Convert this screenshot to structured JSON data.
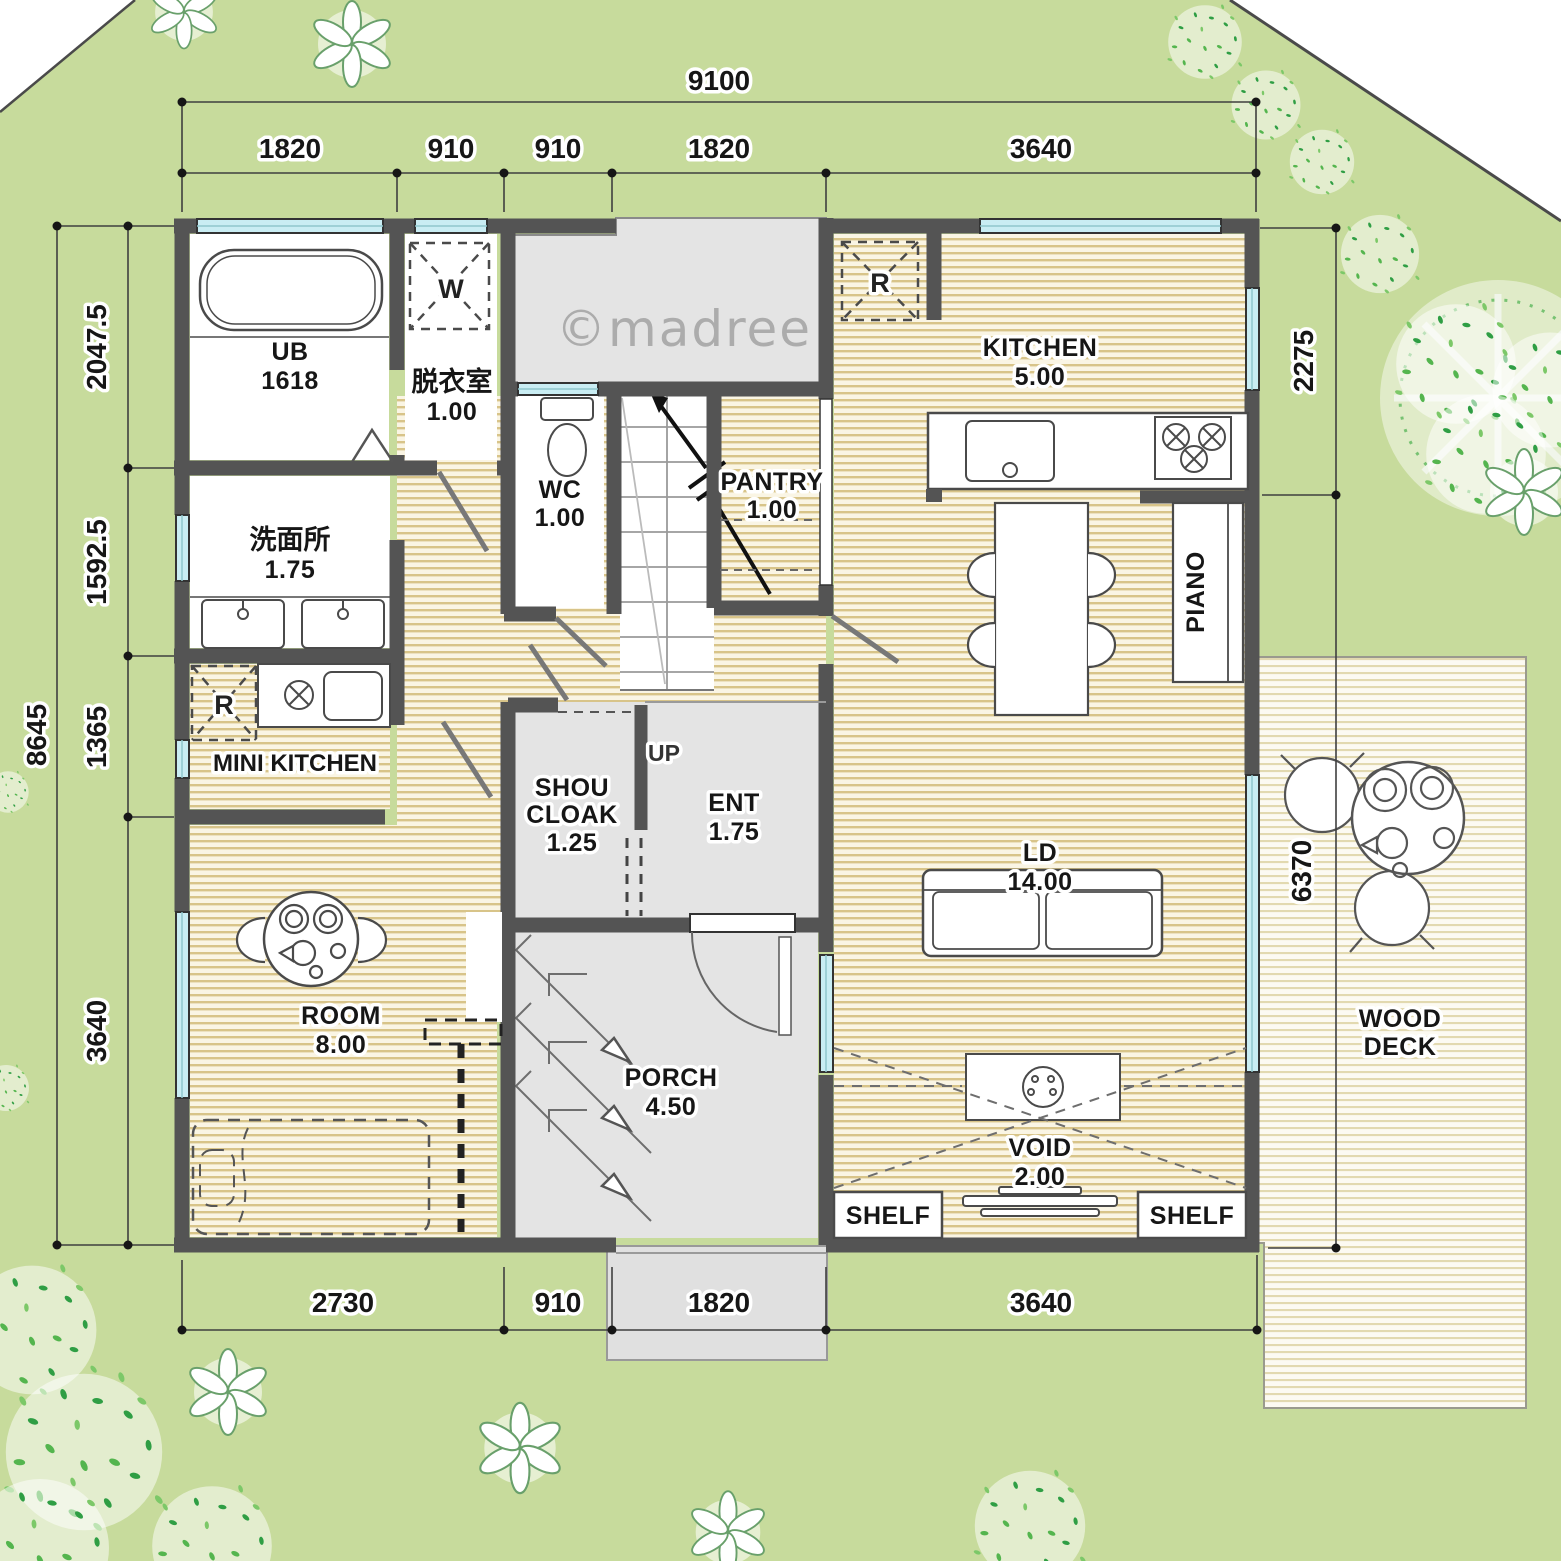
{
  "watermark": "©madree",
  "dim": {
    "top_total": "9100",
    "top": [
      "1820",
      "910",
      "910",
      "1820",
      "3640"
    ],
    "left_total": "8645",
    "left": [
      "2047.5",
      "1592.5",
      "1365",
      "3640"
    ],
    "right": [
      "2275",
      "6370"
    ],
    "bottom": [
      "2730",
      "910",
      "1820",
      "3640"
    ]
  },
  "rooms": {
    "ub": {
      "name": "UB",
      "size": "1618"
    },
    "datsui": {
      "name": "脱衣室",
      "size": "1.00"
    },
    "wc": {
      "name": "WC",
      "size": "1.00"
    },
    "pantry": {
      "name": "PANTRY",
      "size": "1.00"
    },
    "kitchen": {
      "name": "KITCHEN",
      "size": "5.00"
    },
    "senmen": {
      "name": "洗面所",
      "size": "1.75"
    },
    "minikitchen": {
      "name": "MINI KITCHEN"
    },
    "shoucloak": {
      "line1": "SHOU",
      "line2": "CLOAK",
      "size": "1.25"
    },
    "ent": {
      "name": "ENT",
      "size": "1.75"
    },
    "ld": {
      "name": "LD",
      "size": "14.00"
    },
    "piano": {
      "name": "PIANO"
    },
    "room": {
      "name": "ROOM",
      "size": "8.00"
    },
    "porch": {
      "name": "PORCH",
      "size": "4.50"
    },
    "void": {
      "name": "VOID",
      "size": "2.00"
    },
    "shelf_left": "SHELF",
    "shelf_right": "SHELF",
    "wooddeck": {
      "line1": "WOOD",
      "line2": "DECK"
    }
  },
  "marks": {
    "up": "UP",
    "washer": "W",
    "fridge": "R",
    "fridge_mini": "R"
  },
  "colors": {
    "lawn": "#c7db9c",
    "wall": "#545454",
    "window": "#c9edf3",
    "wood_floor_line": "#d8c489",
    "gray_floor": "#e4e4e4",
    "deck_line": "#e2d9b0",
    "boundary": "#4a4a4a"
  }
}
